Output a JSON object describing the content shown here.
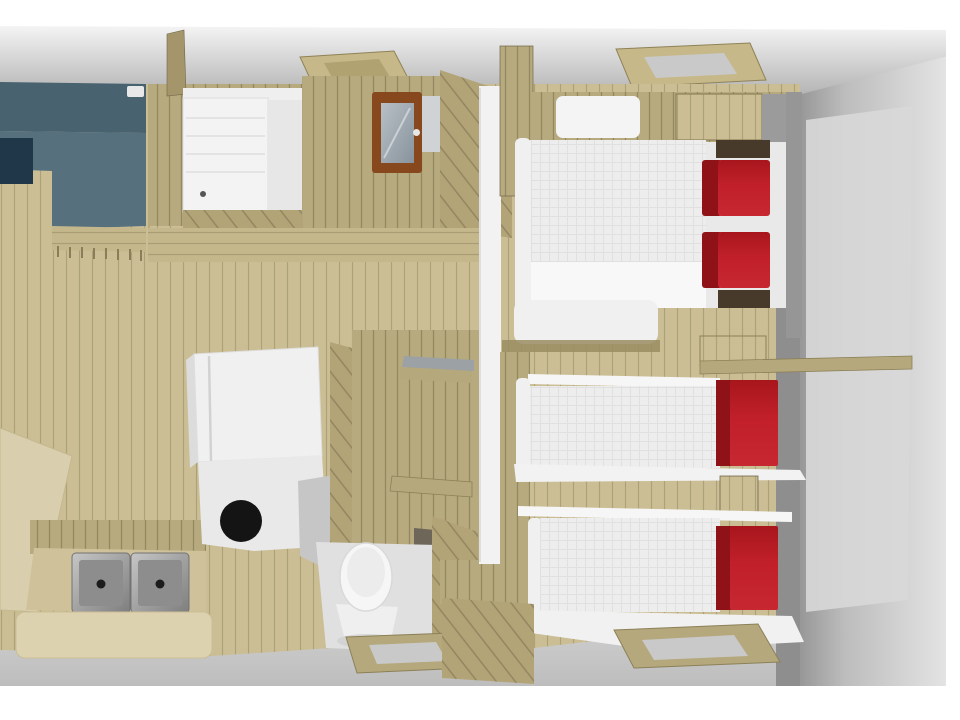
{
  "scene": {
    "kind": "3d-floorplan-rendering",
    "view": "isometric-cutaway",
    "rooms": [
      "lounge",
      "shower-room",
      "kitchen",
      "toilet-room",
      "double-bedroom",
      "twin-bedroom-1",
      "twin-bedroom-2",
      "corridor"
    ],
    "objects": [
      "corner-sofa-blue",
      "dining-table",
      "double-sink",
      "fridge-cabinet",
      "hob-ring",
      "shower-tray",
      "mirror-cabinet",
      "toilet",
      "double-bed",
      "single-bed-1",
      "single-bed-2",
      "red-bolster-cushions",
      "wardrobe",
      "overhead-cabinet",
      "wall-shelf",
      "stool",
      "roof-skylight-1",
      "roof-skylight-2",
      "roof-skylight-3",
      "roof-skylight-4"
    ]
  },
  "colors": {
    "page_bg": "#ffffff",
    "ceiling_light": "#f4f4f4",
    "ceiling_dark": "#b2b2b2",
    "wall_gray_dark": "#8e8e8e",
    "wall_gray_mid": "#9b9b9b",
    "wall_panel": "#d8d8d8",
    "floor_wood": "#cbbe94",
    "floor_wood_line": "#94885f",
    "wall_wood": "#b7aa7e",
    "wall_wood_line": "#7d714c",
    "wood_diag": "#b3a478",
    "wood_diag_line": "#6e6344",
    "wood_h": "#c4b78c",
    "wood_trim": "#b5a87c",
    "wood_trim_edge": "#8c8058",
    "wood_post": "#a4966a",
    "dark_wood": "#483a2b",
    "dark_brown_edge": "#5b4e3c",
    "mirror_frame": "#87481d",
    "panel_gray": "#cfd3d5",
    "sofa_blue": "#56707e",
    "sofa_blue_dark": "#48626f",
    "sofa_navy": "#203749",
    "bed_white": "#ededed",
    "bed_grid_line": "#e0e0e0",
    "bed_duvet": "#f8f8f8",
    "bed_frame_white": "#f0f0f0",
    "bed_head_frame": "#e9e9e9",
    "cushion_red": "#c1202a",
    "cushion_red_dark": "#8e1217",
    "appliance_white": "#f0f0f0",
    "counter_white": "#e9e9e9",
    "counter_gray": "#c6c6c6",
    "hob_black": "#141414",
    "sink_counter": "#cfc29a",
    "sink_front": "#ddd2b0",
    "sink_inner": "#8d8d8d",
    "sink_drain": "#1c1c1c",
    "toilet_white": "#f6f6f6",
    "toilet_floor": "#e0e0e0",
    "table_cream": "#d9cfae",
    "shelf_gray": "#9ba1a5",
    "skylight_inner_gray": "#c9c9c9",
    "skylight_inner_wood": "#b1a271",
    "doorway_shadow": "#6e6659",
    "pillow_white": "#f4f4f4",
    "shower_white": "#f3f3f3",
    "glass_panel": "#e7e7e7",
    "plank_board": "#9a8d62",
    "mid_gray_gap": "#969696"
  }
}
